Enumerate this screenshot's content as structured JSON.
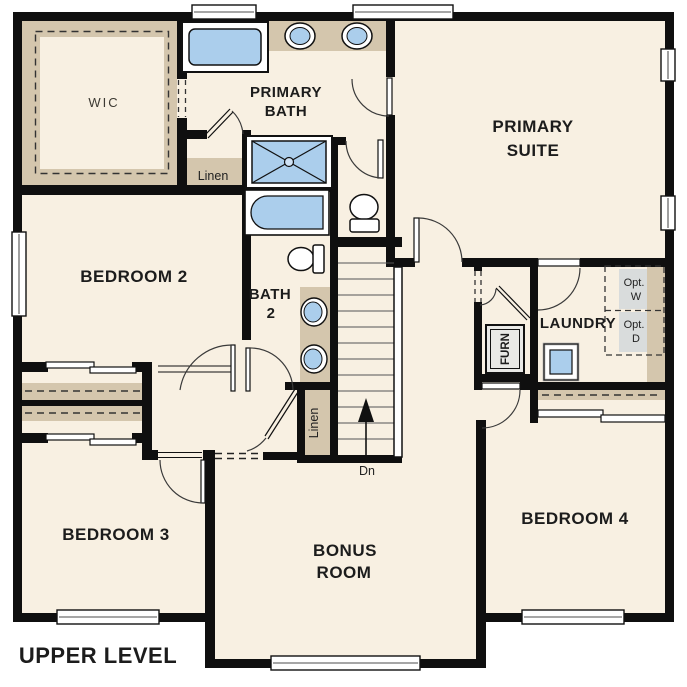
{
  "title": "UPPER LEVEL",
  "colors": {
    "floor": "#f8f0e2",
    "wall": "#0f0f0f",
    "casework_tan": "#d4c6ad",
    "fixture_blue": "#abceec",
    "window_white": "#ffffff",
    "appliance_gray": "#d9dcdc"
  },
  "rooms": {
    "wic": "WIC",
    "primary_bath_1": "PRIMARY",
    "primary_bath_2": "BATH",
    "primary_suite_1": "PRIMARY",
    "primary_suite_2": "SUITE",
    "bedroom2": "BEDROOM 2",
    "bath2_1": "BATH",
    "bath2_2": "2",
    "laundry": "LAUNDRY",
    "bedroom3": "BEDROOM 3",
    "bonus_1": "BONUS",
    "bonus_2": "ROOM",
    "bedroom4": "BEDROOM 4"
  },
  "fixtures": {
    "linen_upper": "Linen",
    "linen_stairs": "Linen",
    "furnace": "FURN",
    "opt_washer_1": "Opt.",
    "opt_washer_2": "W",
    "opt_dryer_1": "Opt.",
    "opt_dryer_2": "D",
    "stairs_down": "Dn"
  }
}
